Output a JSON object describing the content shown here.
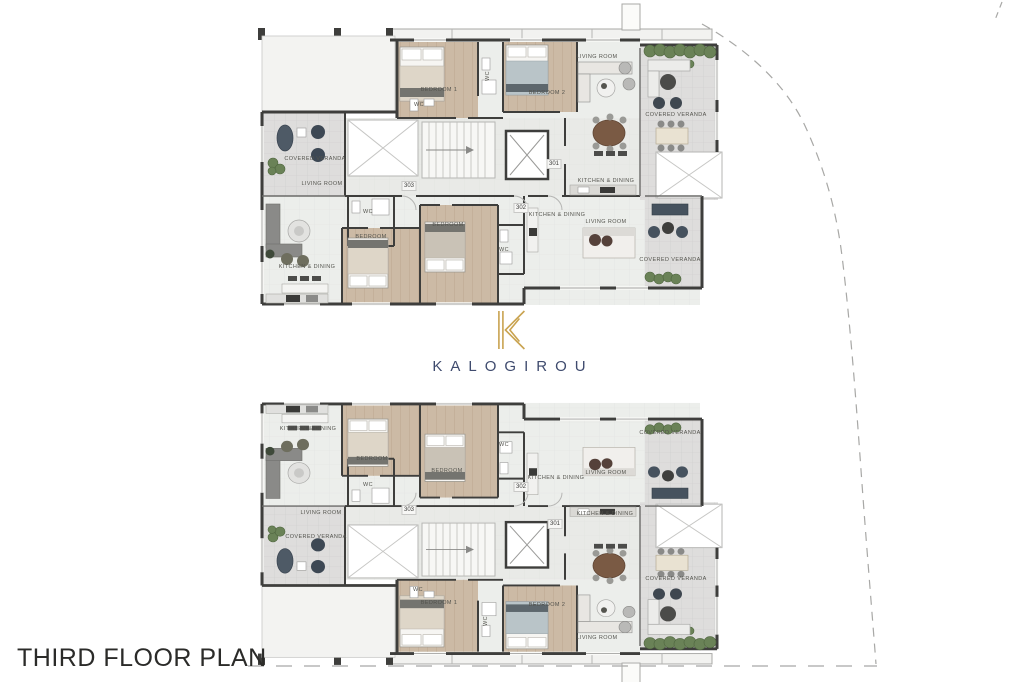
{
  "title": "THIRD FLOOR PLAN",
  "logo": {
    "mark": "K",
    "name": "KALOGIROU"
  },
  "room_labels": {
    "living_room": "LIVING ROOM",
    "covered_veranda": "COVERED VERANDA",
    "kitchen_dining": "KITCHEN & DINING",
    "bedroom": "BEDROOM",
    "bedroom_1": "BEDROOM 1",
    "bedroom_2": "BEDROOM 2",
    "wc": "WC"
  },
  "unit_numbers": {
    "unit_301": "301",
    "unit_302": "302",
    "unit_303": "303"
  },
  "colors": {
    "wall": "#3e3e3c",
    "wood_floor": "#ccbaa5",
    "tile_floor": "#ebebe9",
    "veranda_floor": "#dedddc",
    "plant_green": "#6a8257",
    "logo_gold": "#c9a350",
    "logo_navy": "#3f4b6e",
    "boundary_gray": "#a8a8a6"
  }
}
